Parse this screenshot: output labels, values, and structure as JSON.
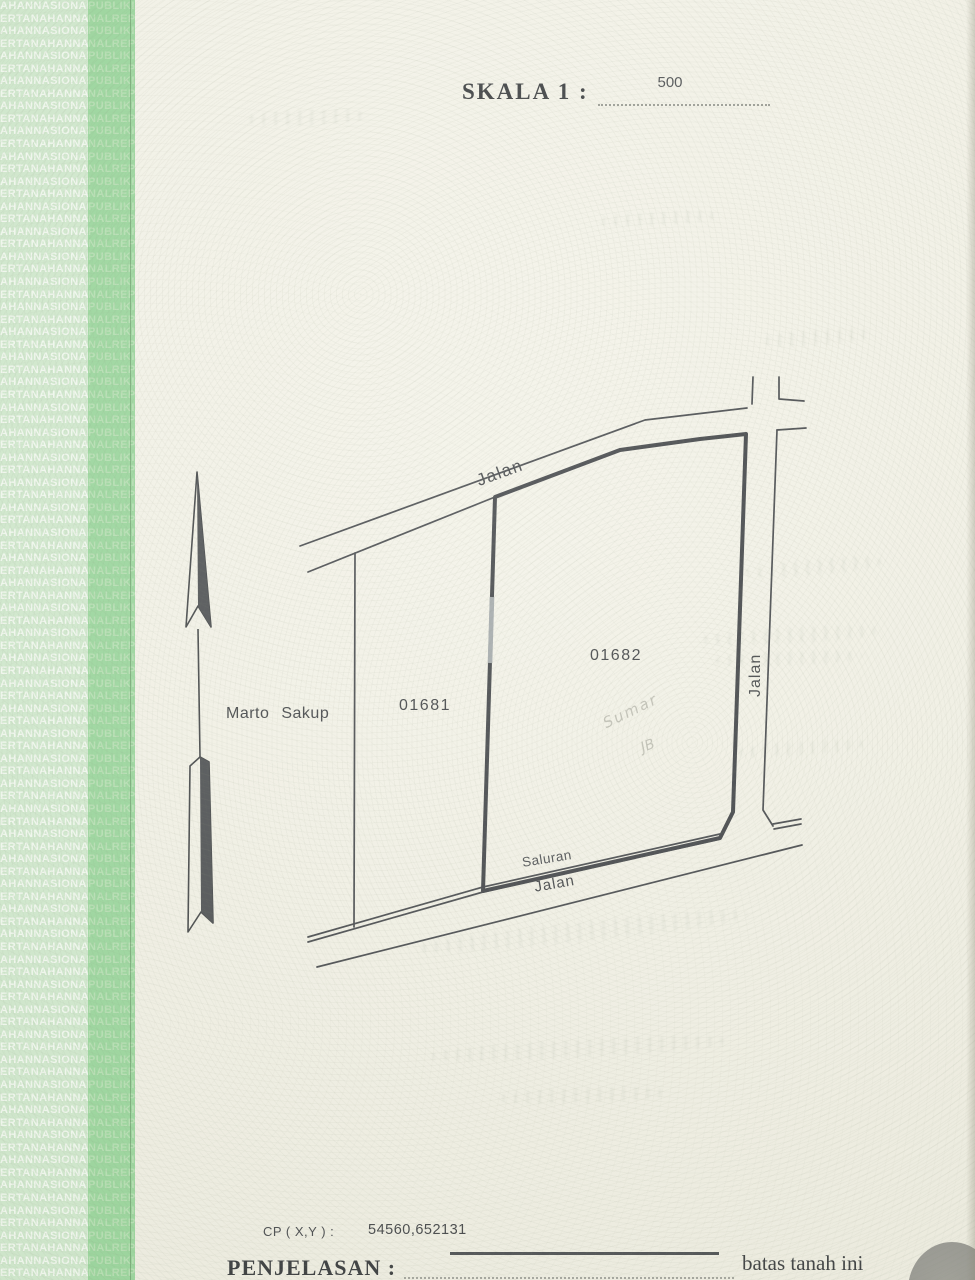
{
  "header": {
    "scale_label": "SKALA 1 :",
    "scale_value": "500"
  },
  "security_strip": {
    "pattern_text": "PERTANAHANNASIONALREPUBLIKINDONESIABADAN",
    "rows": 102,
    "row_offsets": [
      6,
      1
    ],
    "dark_band_extra_offset": 14
  },
  "map": {
    "owner_name": "Marto Sakup",
    "parcel_ids": [
      "01681",
      "01682"
    ],
    "road_label_top": "Jalan",
    "road_label_right": "Jalan",
    "road_label_bottom": "Jalan",
    "ditch_label": "Saluran",
    "handwriting_line1": "Sumar",
    "handwriting_line2": "JB"
  },
  "footer": {
    "cp_label": "CP ( X,Y ) :",
    "cp_value": "54560,652131",
    "explanation_label": "PENJELASAN :",
    "explanation_value": "batas tanah ini"
  },
  "colors": {
    "paper": "#f1f0e4",
    "ink": "#33363a",
    "strip_light_bg": "#cbe6c8",
    "strip_light_text": "#f0f8ee",
    "strip_dark_bg": "#90d293",
    "strip_dark_text": "#aedcab",
    "pencil": "#9a9a90",
    "blob_gray": "#8e8e88"
  }
}
